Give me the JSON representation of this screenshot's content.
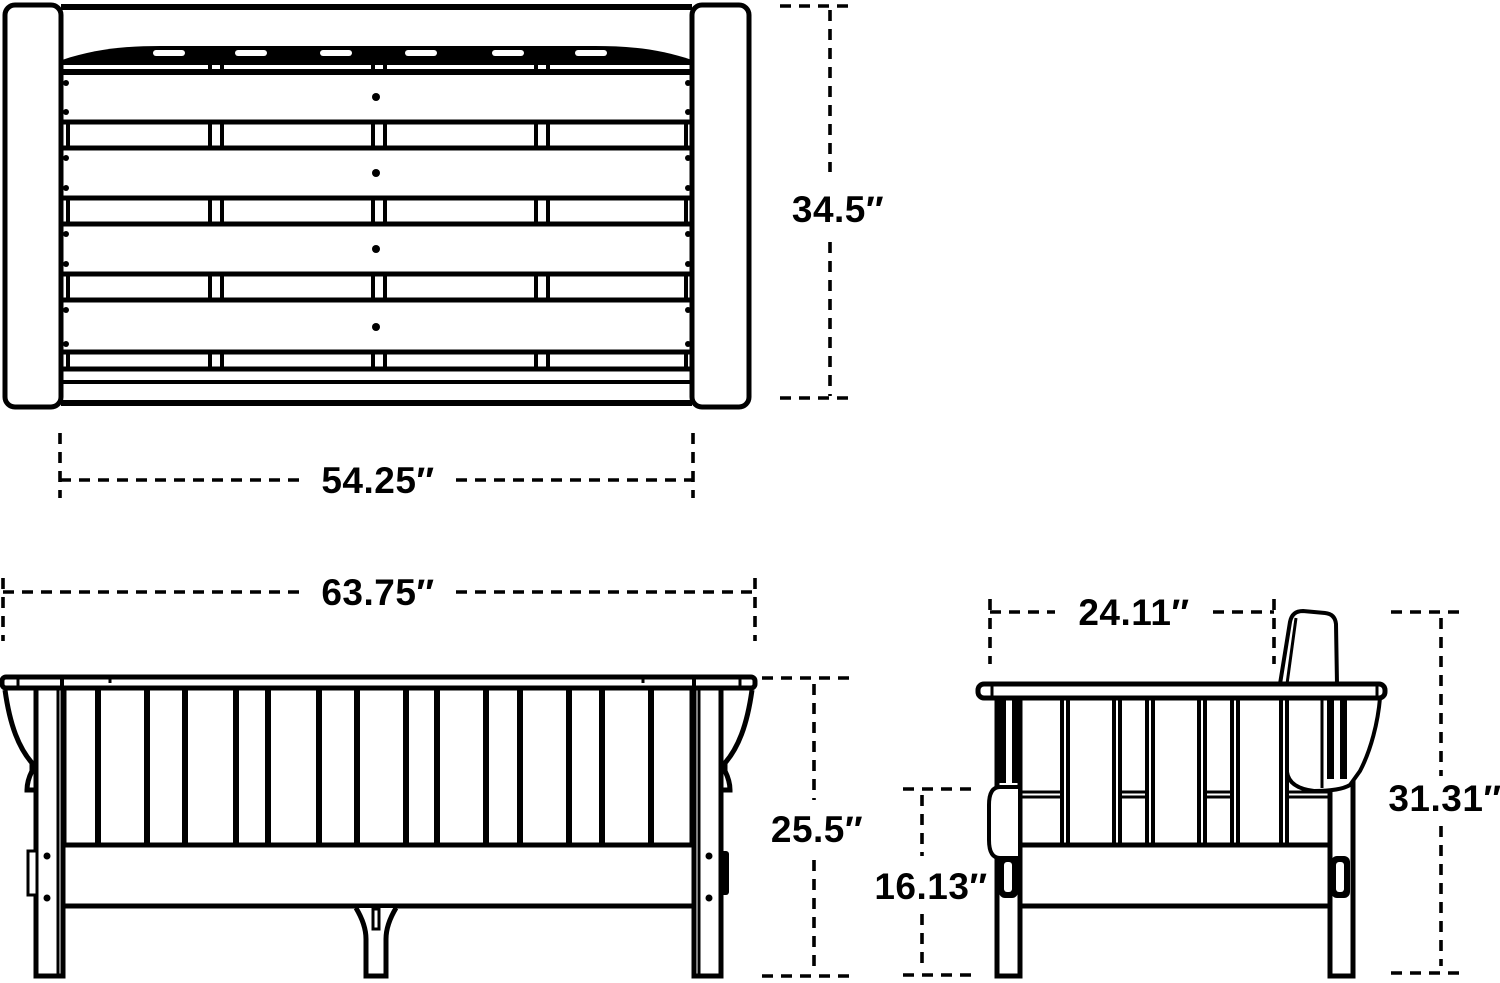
{
  "colors": {
    "background": "#ffffff",
    "line": "#000000"
  },
  "views": {
    "top": {
      "width_label": "54.25″",
      "height_label": "34.5″"
    },
    "front": {
      "width_label": "63.75″",
      "height_label": "25.5″"
    },
    "side": {
      "width_label": "24.11″",
      "seat_height_label": "16.13″",
      "overall_height_label": "31.31″"
    }
  }
}
